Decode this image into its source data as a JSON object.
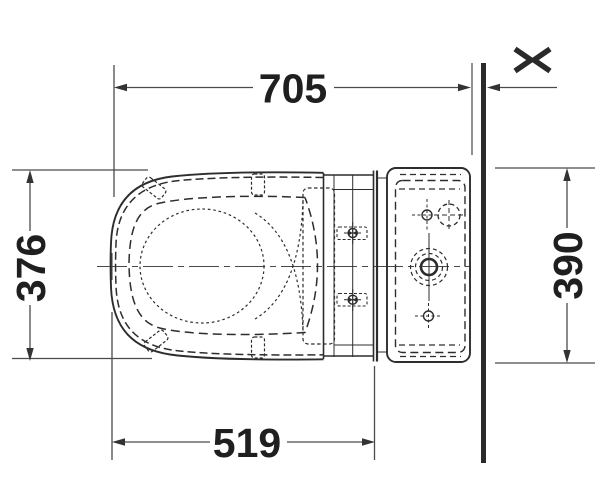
{
  "dimensions": {
    "top": "705",
    "left": "376",
    "right": "390",
    "bottom": "519"
  },
  "wall_symbol": {
    "glyph": "><",
    "icon": "variable-distance-icon"
  },
  "colors": {
    "drawing_line": "#2d2d2d",
    "dimension_line": "#4a4a4a",
    "text": "#1f1f1f",
    "wall": "#2a2a2a",
    "background": "#ffffff"
  }
}
